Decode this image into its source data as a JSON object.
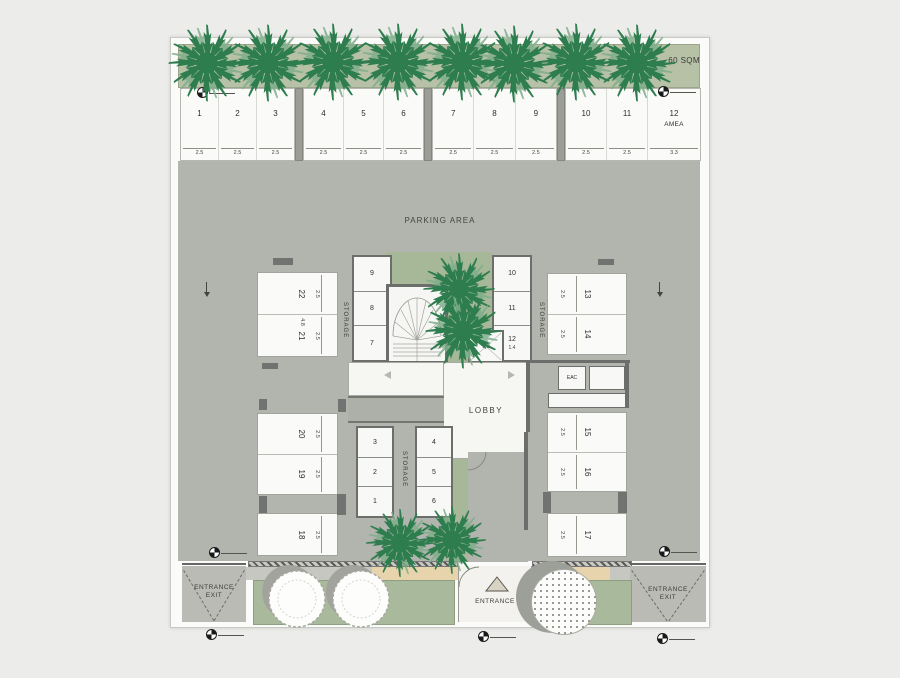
{
  "labels": {
    "area_sqm": "60 SQM",
    "parking_area": "PARKING AREA",
    "lobby": "LOBBY",
    "eac": "EAC",
    "storage": "STORAGE",
    "entrance": "ENTRANCE",
    "exit": "EXIT"
  },
  "dims": {
    "stall_length": "4.8",
    "storage_unit_12_width": "1.4",
    "elevator_width": "1.8"
  },
  "stall_groups": [
    {
      "stalls": [
        {
          "n": "1",
          "d": "2.5"
        },
        {
          "n": "2",
          "d": "2.5"
        },
        {
          "n": "3",
          "d": "2.5"
        }
      ]
    },
    {
      "stalls": [
        {
          "n": "4",
          "d": "2.5"
        },
        {
          "n": "5",
          "d": "2.5"
        },
        {
          "n": "6",
          "d": "2.5"
        }
      ]
    },
    {
      "stalls": [
        {
          "n": "7",
          "d": "2.5"
        },
        {
          "n": "8",
          "d": "2.5"
        },
        {
          "n": "9",
          "d": "2.5"
        }
      ]
    },
    {
      "stalls": [
        {
          "n": "10",
          "d": "2.5"
        },
        {
          "n": "11",
          "d": "2.5"
        },
        {
          "n": "12",
          "d": "3.3",
          "sub": "AMEA"
        }
      ]
    }
  ],
  "left_stalls": [
    {
      "n": "22",
      "d": "2.5"
    },
    {
      "n": "21",
      "d": "2.5"
    },
    {
      "n": "20",
      "d": "2.5"
    },
    {
      "n": "19",
      "d": "2.5"
    },
    {
      "n": "18",
      "d": "2.5"
    }
  ],
  "right_stalls": [
    {
      "n": "13",
      "d": "2.5"
    },
    {
      "n": "14",
      "d": "2.5"
    },
    {
      "n": "15",
      "d": "2.5"
    },
    {
      "n": "16",
      "d": "2.5"
    },
    {
      "n": "17",
      "d": "2.5"
    }
  ],
  "storage_upper_left": [
    "9",
    "8",
    "7"
  ],
  "storage_upper_right": [
    "10",
    "11",
    "12"
  ],
  "storage_lower_left": [
    "3",
    "2",
    "1"
  ],
  "storage_lower_right": [
    "4",
    "5",
    "6"
  ],
  "colors": {
    "page_bg": "#ececea",
    "sheet_bg": "#fbfbf9",
    "parking_gray": "#b2b4ae",
    "planting_green": "#b6c1a6",
    "courtyard_green": "#a6b897",
    "palm_green": "#2e7d4e",
    "wall_dark": "#6b6e6a",
    "sidewalk_tan": "#e7d4ad"
  }
}
